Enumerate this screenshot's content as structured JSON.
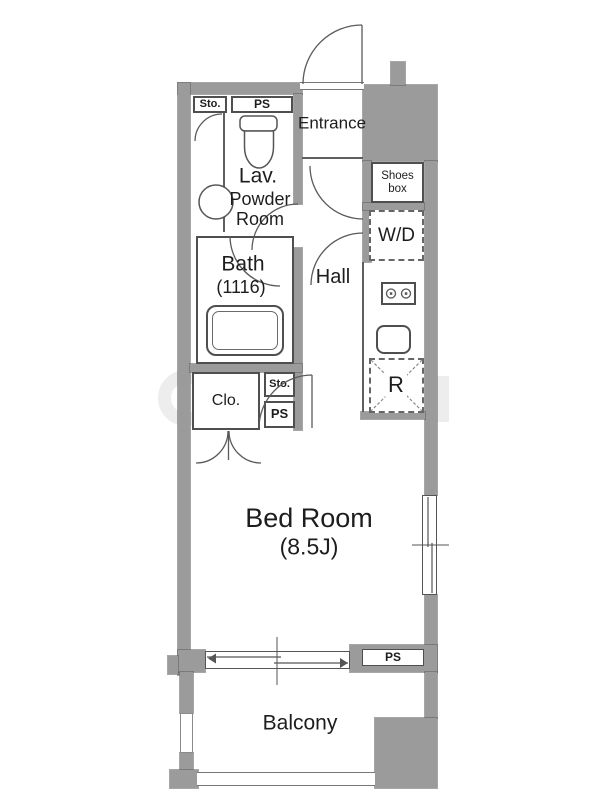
{
  "plan_type": "apartment floor plan",
  "colors": {
    "wall": "#9b9b9b",
    "wall_edge": "#6f6f6f",
    "line": "#555555",
    "text": "#1d1d1d",
    "background": "#ffffff",
    "watermark": "#ededed"
  },
  "labels": {
    "entrance": "Entrance",
    "shoes_box": "Shoes box",
    "washer_dryer": "W/D",
    "hall": "Hall",
    "lavatory": "Lav.",
    "powder_room": "Powder Room",
    "bath": "Bath",
    "bath_size": "(1116)",
    "closet": "Clo.",
    "storage_top": "Sto.",
    "pipe_space_top": "PS",
    "storage_mid": "Sto.",
    "pipe_space_mid": "PS",
    "refrigerator": "R",
    "bedroom": "Bed Room",
    "bedroom_size": "(8.5J)",
    "pipe_space_bottom": "PS",
    "balcony": "Balcony"
  }
}
